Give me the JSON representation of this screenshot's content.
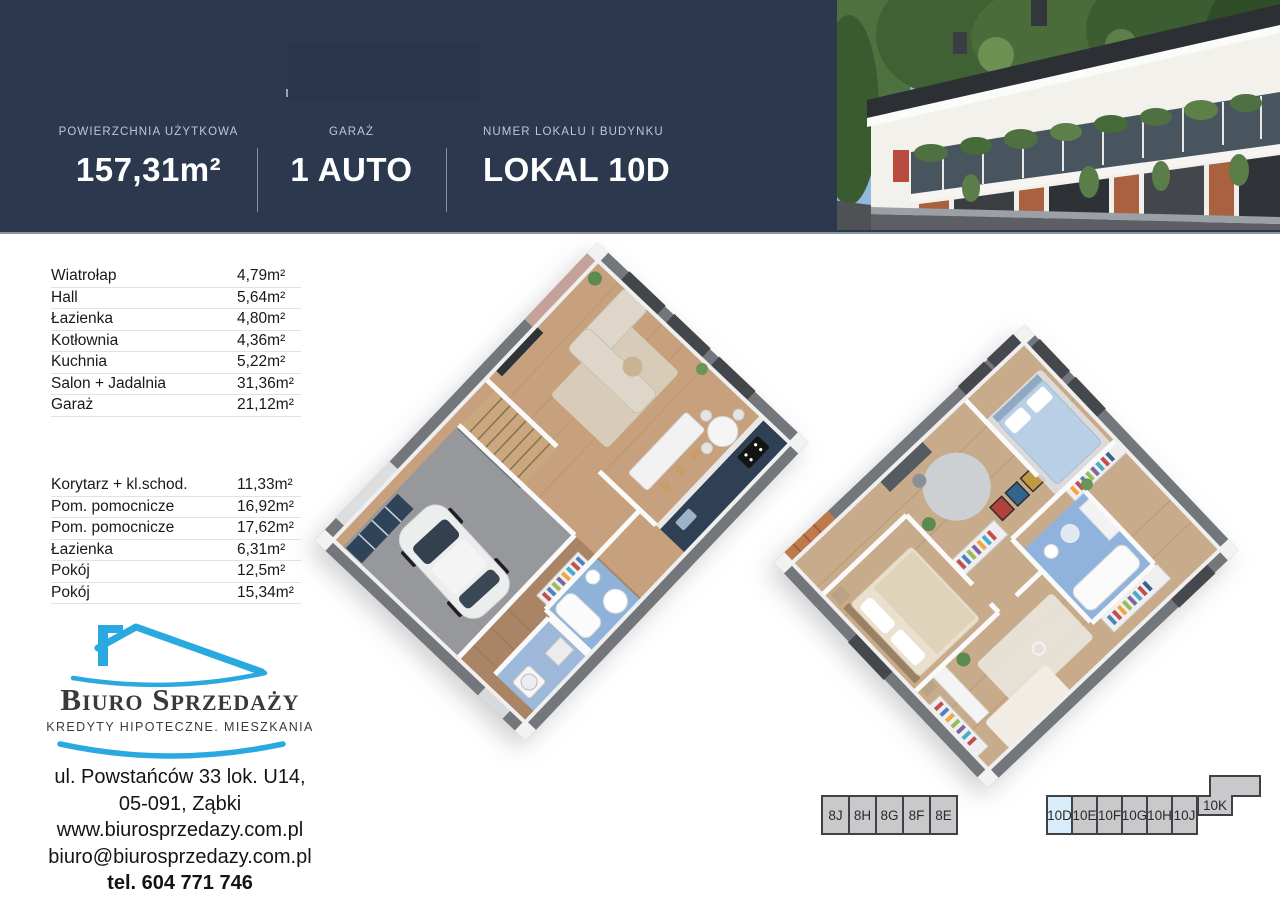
{
  "header": {
    "stats": [
      {
        "label": "POWIERZCHNIA UŻYTKOWA",
        "value": "157,31m²"
      },
      {
        "label": "GARAŻ",
        "value": "1 AUTO"
      },
      {
        "label": "NUMER LOKALU I BUDYNKU",
        "value": "LOKAL 10D"
      }
    ]
  },
  "rooms": {
    "ground": [
      {
        "name": "Wiatrołap",
        "area": "4,79m²"
      },
      {
        "name": "Hall",
        "area": "5,64m²"
      },
      {
        "name": "Łazienka",
        "area": "4,80m²"
      },
      {
        "name": "Kotłownia",
        "area": "4,36m²"
      },
      {
        "name": "Kuchnia",
        "area": "5,22m²"
      },
      {
        "name": "Salon + Jadalnia",
        "area": "31,36m²"
      },
      {
        "name": "Garaż",
        "area": "21,12m²"
      }
    ],
    "upper": [
      {
        "name": "Korytarz + kl.schod.",
        "area": "11,33m²"
      },
      {
        "name": "Pom. pomocnicze",
        "area": "16,92m²"
      },
      {
        "name": "Pom. pomocnicze",
        "area": "17,62m²"
      },
      {
        "name": "Łazienka",
        "area": "6,31m²"
      },
      {
        "name": "Pokój",
        "area": "12,5m²"
      },
      {
        "name": "Pokój",
        "area": "15,34m²"
      }
    ]
  },
  "agency": {
    "name": "Biuro Sprzedaży",
    "tagline": "KREDYTY HIPOTECZNE. MIESZKANIA",
    "address_line1": "ul. Powstańców 33 lok. U14,",
    "address_line2": "05-091, Ząbki",
    "website": "www.biurosprzedazy.com.pl",
    "email": "biuro@biurosprzedazy.com.pl",
    "phone": "tel. 604 771 746"
  },
  "buildings": {
    "b8": {
      "units": [
        "8J",
        "8H",
        "8G",
        "8F",
        "8E"
      ]
    },
    "b10": {
      "units": [
        "10D",
        "10E",
        "10F",
        "10G",
        "10H",
        "10J"
      ],
      "offset_unit": "10K",
      "highlighted_unit": "10D",
      "highlight_color": "#d9ecf9"
    }
  },
  "colors": {
    "header_bg": "#2b384e",
    "accent_blue": "#29a9e0",
    "cell_gray": "#c9c9cb"
  }
}
